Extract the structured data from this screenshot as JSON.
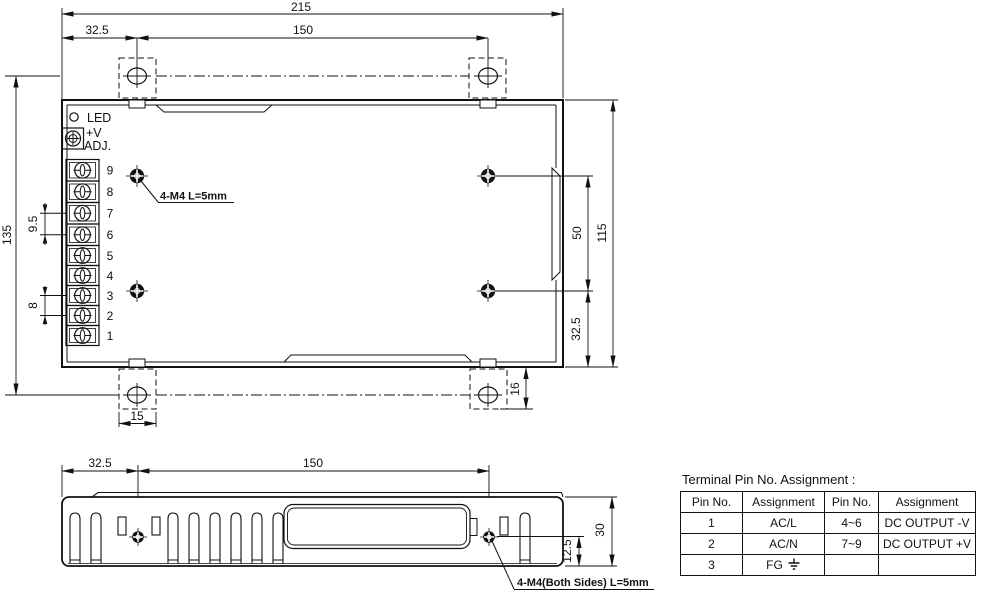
{
  "top_view": {
    "dims": {
      "overall_width": "215",
      "mount_hole_offset_x": "32.5",
      "mount_hole_span_x": "150",
      "overall_depth": "135",
      "terminal_pitch_output": "9.5",
      "terminal_pitch_input": "8",
      "mount_hole_span_y": "50",
      "case_depth": "115",
      "mount_hole_offset_y": "32.5",
      "bracket_overhang": "16",
      "bracket_width": "15"
    },
    "led_label": "LED",
    "vadj_label_line1": "+V",
    "vadj_label_line2": "ADJ.",
    "mounting_note": "4-M4 L=5mm",
    "terminal_numbers": [
      "9",
      "8",
      "7",
      "6",
      "5",
      "4",
      "3",
      "2",
      "1"
    ]
  },
  "side_view": {
    "dims": {
      "mount_hole_offset_x": "32.5",
      "mount_hole_span_x": "150",
      "case_height": "30",
      "mount_hole_center_height": "12.5"
    },
    "mounting_note": "4-M4(Both Sides) L=5mm"
  },
  "pin_table": {
    "title": "Terminal Pin No. Assignment :",
    "headers": [
      "Pin No.",
      "Assignment",
      "Pin No.",
      "Assignment"
    ],
    "rows": [
      [
        "1",
        "AC/L",
        "4~6",
        "DC OUTPUT -V"
      ],
      [
        "2",
        "AC/N",
        "7~9",
        "DC OUTPUT +V"
      ],
      [
        "3",
        "FG",
        "",
        ""
      ]
    ],
    "ground_symbol_icon": "earth-ground"
  },
  "colors": {
    "line": "#111111",
    "background": "#ffffff"
  }
}
